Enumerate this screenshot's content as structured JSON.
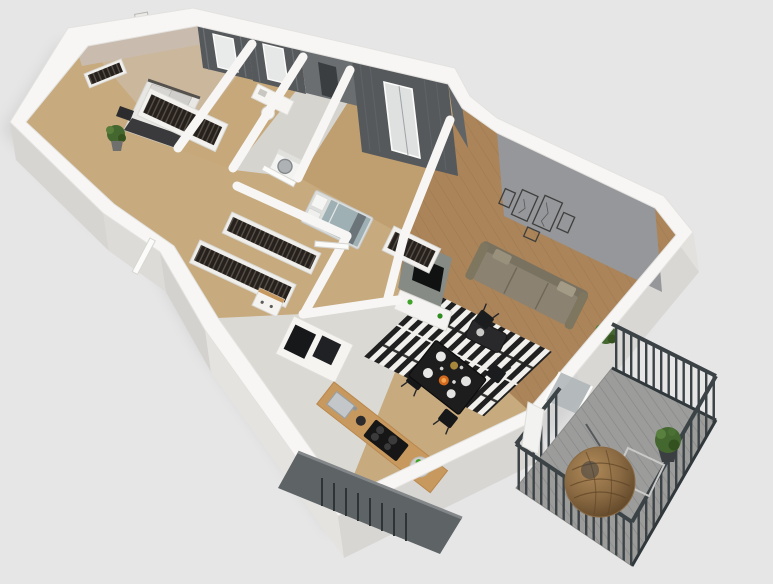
{
  "image": {
    "type": "3d-floor-plan-render",
    "description": "Isometric 3D cutaway floor plan render of a two-bedroom apartment with open living-dining room, kitchen, walk-in closet and a balcony with a hanging egg chair",
    "projection": "axonometric cutaway, oriented diagonally from upper-left to lower-right",
    "background": "#e6e6e7"
  },
  "palette": {
    "bg": "#e6e6e7",
    "wall_top": "#f7f6f4",
    "wall_face": "#e0dfdc",
    "wall_face_dark": "#d3d2cf",
    "shadow": "#b5b5b3",
    "beige_wall": "#c9bcae",
    "dark_wall": "#55595c",
    "dark_wall2": "#6a6e71",
    "accent_wall": "#95979a",
    "tv_wall": "#868b86",
    "floor_base": "#c7aa7e",
    "floor_master": "#cbb79c",
    "floor_office": "#c6a87a",
    "floor_bath": "#d6d4cf",
    "floor_bed2": "#bf9e6f",
    "floor_living": "#ab8459",
    "floor_kitchen": "#dbd9d4",
    "rug_dark": "#202020",
    "rug_light": "#f1f0ed",
    "sofa": "#8b8271",
    "sofa_back": "#7a7260",
    "closet_dark": "#26211c",
    "closet_stripe": "#5a524a",
    "counter_wood": "#c8995e",
    "cooktop": "#161616",
    "table_black": "#1d1d1d",
    "deck": "#9c9c9a",
    "railing": "#3c4347",
    "egg_chair": "#8a6a43",
    "plant_green": "#44672f",
    "fruit_green": "#3fa32a",
    "orange_dish": "#d2691e",
    "blanket_teal": "#9fb0b4",
    "parapet": "#5e6366",
    "glass": "#aeb4b6"
  },
  "scene": {
    "rooms": [
      {
        "id": "master-bedroom",
        "features": [
          "double-bed",
          "gray-pillows",
          "dark-throw",
          "bookshelf",
          "potted-plant",
          "wall-art-frames",
          "clothes-wardrobe",
          "curtained-window"
        ]
      },
      {
        "id": "office-nook",
        "features": [
          "white-desk",
          "chair",
          "curtained-window"
        ]
      },
      {
        "id": "bathroom-laundry",
        "features": [
          "washing-machine",
          "dark-doorway"
        ]
      },
      {
        "id": "bedroom-2",
        "features": [
          "bed-with-teal-blanket",
          "white-pillows",
          "open-wardrobe",
          "floor-to-ceiling-curtains",
          "window"
        ]
      },
      {
        "id": "walk-in-closet",
        "features": [
          "two-clothes-racks",
          "dresser"
        ]
      },
      {
        "id": "hallway",
        "features": [
          "open-white-doors",
          "entrance-door"
        ]
      },
      {
        "id": "kitchen",
        "features": [
          "l-shaped-wood-counter",
          "black-cooktop",
          "steel-sink",
          "kettle",
          "bowl-of-green-fruit",
          "tall-cabinets",
          "black-appliance-niches"
        ]
      },
      {
        "id": "living-dining-room",
        "features": [
          "olive-three-seat-sofa",
          "black-white-striped-rug",
          "dark-coffee-table",
          "gallery-wall-five-frames",
          "tv-wall",
          "white-sideboard",
          "black-dining-table",
          "four-black-chairs",
          "plates-and-glasses",
          "balcony-door"
        ]
      },
      {
        "id": "balcony",
        "features": [
          "gray-plank-deck",
          "dark-metal-slat-railing",
          "hanging-rattan-egg-chair",
          "potted-plant",
          "thin-frame-side-table"
        ]
      },
      {
        "id": "exterior",
        "features": [
          "white-cutaway-walls",
          "dark-parapet-below-kitchen-window",
          "soft-ground-shadow"
        ]
      }
    ]
  }
}
